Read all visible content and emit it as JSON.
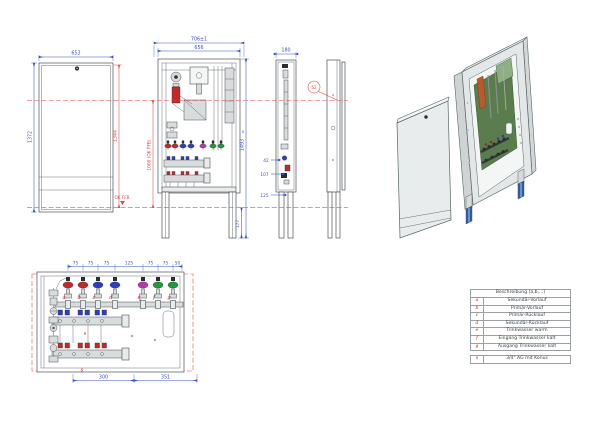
{
  "drawing": {
    "front_view": {
      "dim_width": "653",
      "dim_height": "1372",
      "dim_height_inner": "1344",
      "floor_label": "OK FFB"
    },
    "cabinet_view": {
      "dim_width_outer": "706±1",
      "dim_width_inner": "656",
      "dim_height": "1493",
      "dim_leg": "177",
      "dim_manifold": "1000 (OK FFB)",
      "break_mark": "×"
    },
    "side_view": {
      "dim_depth": "180",
      "dim_1": "42",
      "dim_2": "107",
      "dim_3": "125"
    },
    "door_view": {
      "callout": "52"
    },
    "detail_view": {
      "dims_top": [
        "75",
        "75",
        "75",
        "125",
        "75",
        "75",
        "50"
      ],
      "valve_labels": [
        "a",
        "b",
        "c",
        "d",
        "e",
        "f",
        "g"
      ],
      "port_label": "s",
      "port_label2": "s",
      "dim_bottom_left": "300",
      "dim_bottom_right": "351"
    }
  },
  "legend": {
    "header": "Beschreibung (a,b,...)",
    "rows": [
      {
        "key": "a",
        "desc": "Sekundär-Vorlauf"
      },
      {
        "key": "b",
        "desc": "Primär-Vorlauf"
      },
      {
        "key": "c",
        "desc": "Primär-Rücklauf"
      },
      {
        "key": "d",
        "desc": "Sekundär-Rücklauf"
      },
      {
        "key": "e",
        "desc": "Trinkwasser warm"
      },
      {
        "key": "f",
        "desc": "Eingang Trinkwasser kalt"
      },
      {
        "key": "g",
        "desc": "Ausgang Trinkwasser kalt"
      }
    ],
    "extra": {
      "key": "s",
      "desc": "3/4\" AG mit Konus"
    }
  },
  "colors": {
    "dim_blue": "#3c50c8",
    "dim_red": "#e04a4a",
    "line": "#4b5055",
    "valve_red": "#c62828",
    "valve_blue": "#2b3fc4",
    "valve_magenta": "#b837b8",
    "valve_green": "#1d9a3a",
    "leg_blue": "#2b5fa8",
    "panel_green": "#5b7d4e",
    "pump_orange": "#b85a2a"
  }
}
